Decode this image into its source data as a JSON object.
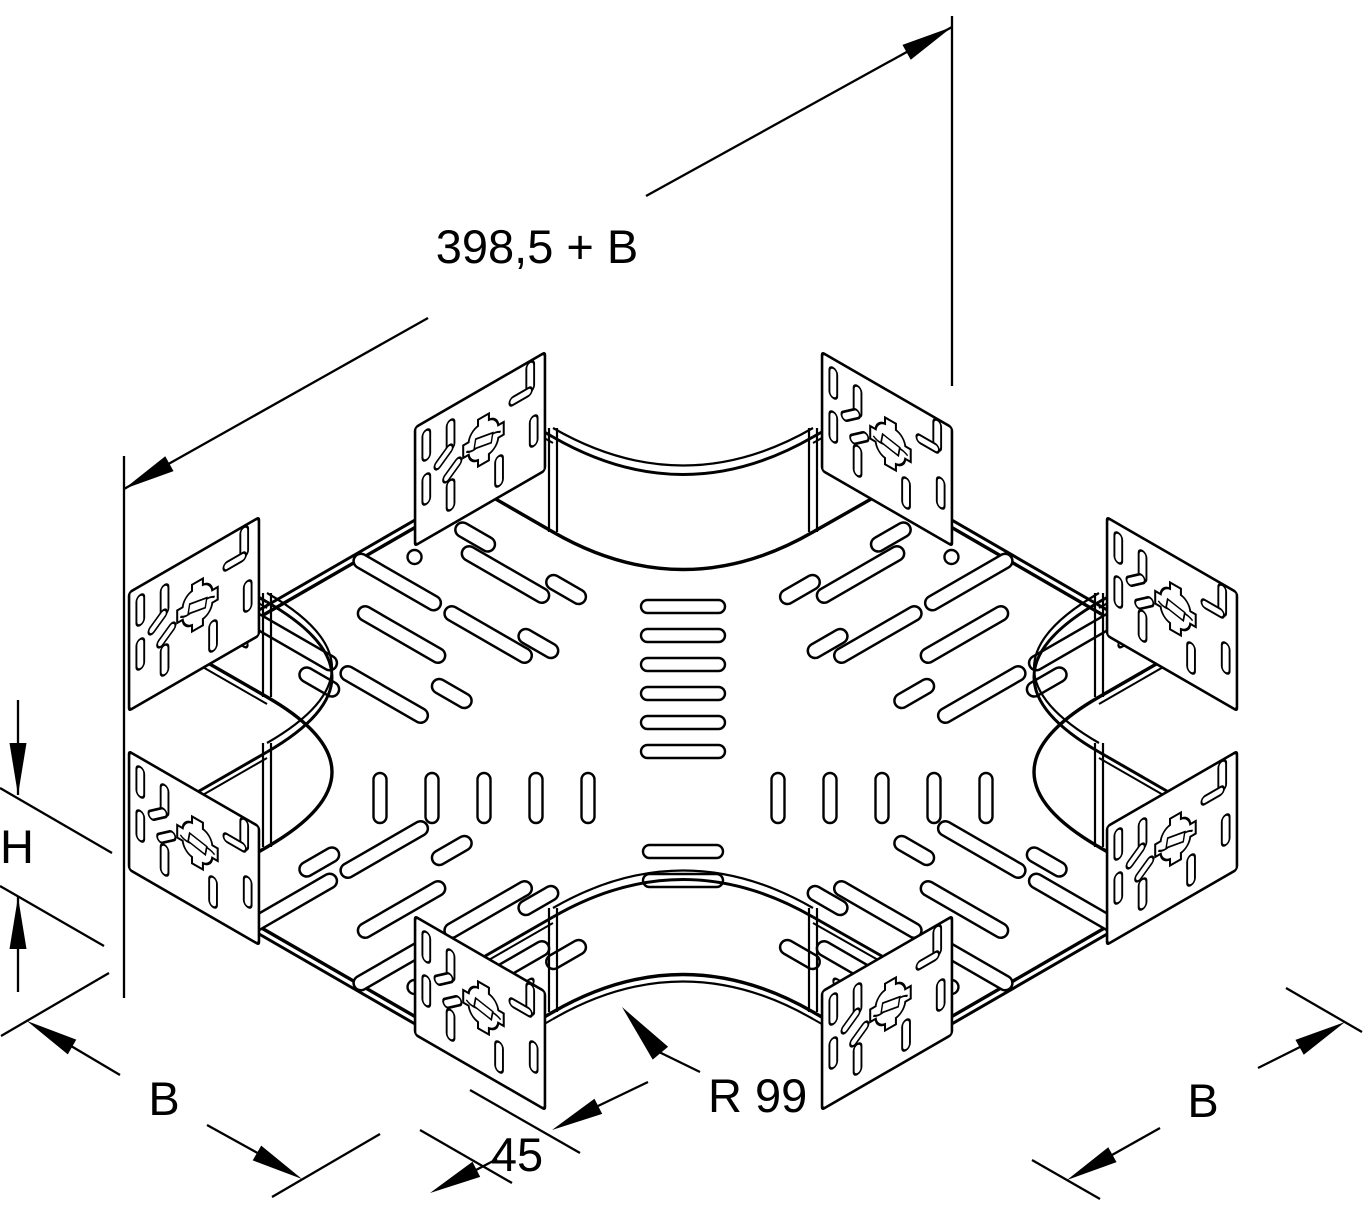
{
  "diagram": {
    "type": "technical-drawing",
    "subject": "cable-tray-cross-piece",
    "background": "#ffffff",
    "line_color": "#000000",
    "dims": {
      "overall": "398,5 + B",
      "height": "H",
      "width_left": "B",
      "end_straight": "45",
      "radius": "R 99",
      "width_right": "B"
    }
  }
}
